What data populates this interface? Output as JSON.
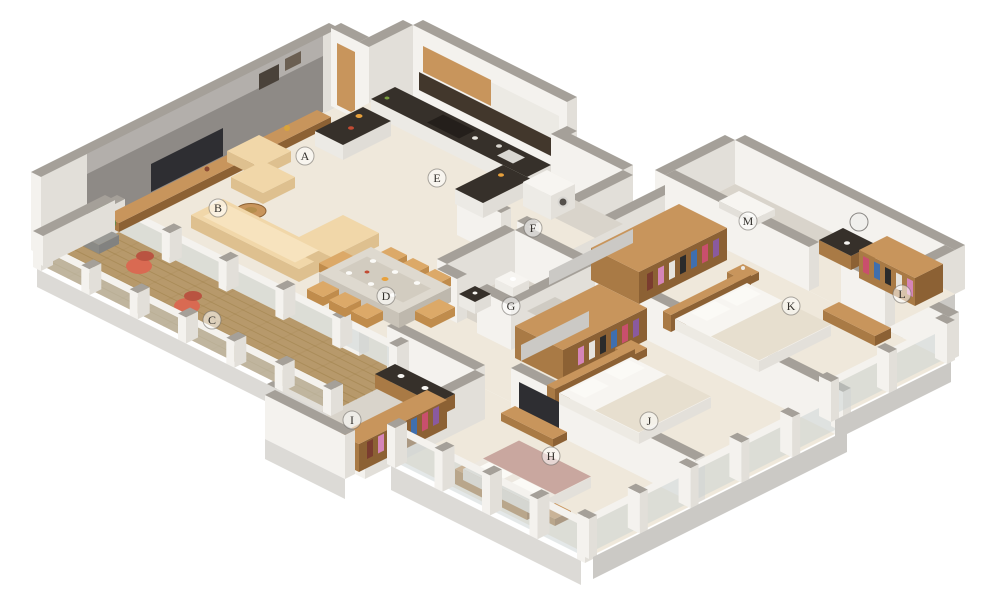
{
  "palette": {
    "background": "#ffffff",
    "wall_top": "#A5A099",
    "wall_face_light": "#F4F2EE",
    "wall_face_shade": "#E2DFD9",
    "wall_gray": "#8E8A86",
    "wall_gray_light": "#B3AFAB",
    "floor_cream": "#EFE8DB",
    "floor_tile": "#D9D4CB",
    "fascia": "#DCDAD6",
    "fascia_shade": "#CBC9C5",
    "deck_wood": "#B7996B",
    "deck_plank_line": "#97793F",
    "wood_top": "#C8955C",
    "wood_face": "#A97A45",
    "wood_dark": "#8C6134",
    "counter_dark": "#36302A",
    "counter_dark2": "#241F1B",
    "sofa": "#F1D7A9",
    "sofa_shade": "#DEC08F",
    "coral": "#D96A52",
    "coral_shade": "#B95441",
    "plant_green": "#5E8B49",
    "plant_green_dark": "#436F2F",
    "white_furniture": "#F7F5F1",
    "white_furniture_shade": "#E3E0DA",
    "bed_blanket": "#E7DFCF",
    "bed_mauve": "#C9A79F",
    "bed_mauve_shade": "#B28F87",
    "glass": "#C9D2D1",
    "tv_dark": "#2E2E32",
    "chair_tan": "#DCA968",
    "chair_tan_shade": "#C08C4C",
    "label_ink": "#33302C",
    "label_circle": "#6B6862",
    "clothes": [
      "#8A5A9E",
      "#C94F6D",
      "#3F6FAE",
      "#2B2B2B",
      "#E6E3DD",
      "#D585B8",
      "#7A3C2F"
    ]
  },
  "plan_labels": [
    {
      "letter": "A",
      "x": 305,
      "y": 156
    },
    {
      "letter": "B",
      "x": 218,
      "y": 208
    },
    {
      "letter": "C",
      "x": 212,
      "y": 320
    },
    {
      "letter": "D",
      "x": 386,
      "y": 296
    },
    {
      "letter": "E",
      "x": 437,
      "y": 178
    },
    {
      "letter": "F",
      "x": 533,
      "y": 228
    },
    {
      "letter": "G",
      "x": 511,
      "y": 306
    },
    {
      "letter": "H",
      "x": 551,
      "y": 456
    },
    {
      "letter": "I",
      "x": 352,
      "y": 420
    },
    {
      "letter": "J",
      "x": 649,
      "y": 421
    },
    {
      "letter": "K",
      "x": 791,
      "y": 306
    },
    {
      "letter": "L",
      "x": 902,
      "y": 294
    },
    {
      "letter": "M",
      "x": 748,
      "y": 221
    }
  ]
}
